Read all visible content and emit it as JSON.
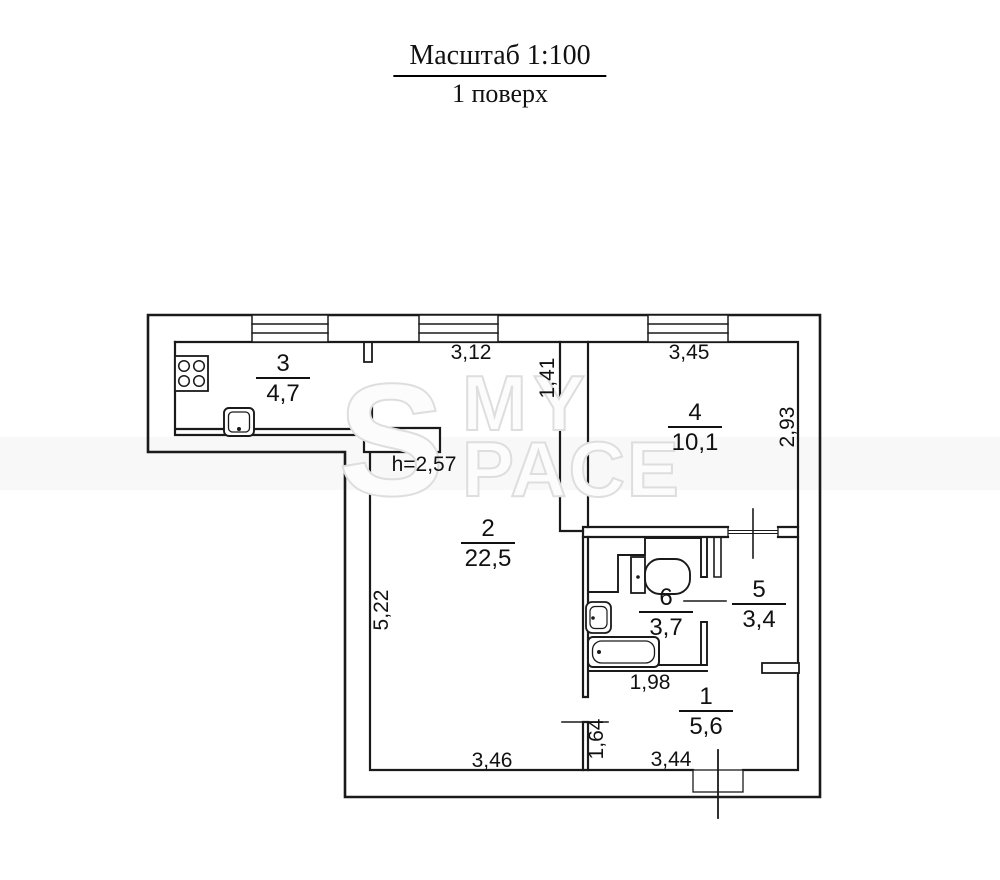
{
  "title": {
    "scale_label": "Масштаб 1:100",
    "floor_label": "1 поверх"
  },
  "watermark": {
    "symbol": "S",
    "word_top": "MY",
    "word_bottom": "PACE"
  },
  "note": {
    "ceiling_height": "h=2,57"
  },
  "rooms": [
    {
      "number": "1",
      "area": "5,6"
    },
    {
      "number": "2",
      "area": "22,5"
    },
    {
      "number": "3",
      "area": "4,7"
    },
    {
      "number": "4",
      "area": "10,1"
    },
    {
      "number": "5",
      "area": "3,4"
    },
    {
      "number": "6",
      "area": "3,7"
    }
  ],
  "dimensions": {
    "room2_top_width": "3,12",
    "room4_top_width": "3,45",
    "kitchen_depth": "1,41",
    "room4_height": "2,93",
    "room2_left_height": "5,22",
    "bathroom_width": "1,98",
    "hall_left_height": "1,64",
    "room2_bottom_width": "3,46",
    "hall_bottom_width": "3,44"
  },
  "colors": {
    "line": "#1a1a1a",
    "watermark_stroke": "#dedede",
    "band": "#f8f8f8"
  }
}
